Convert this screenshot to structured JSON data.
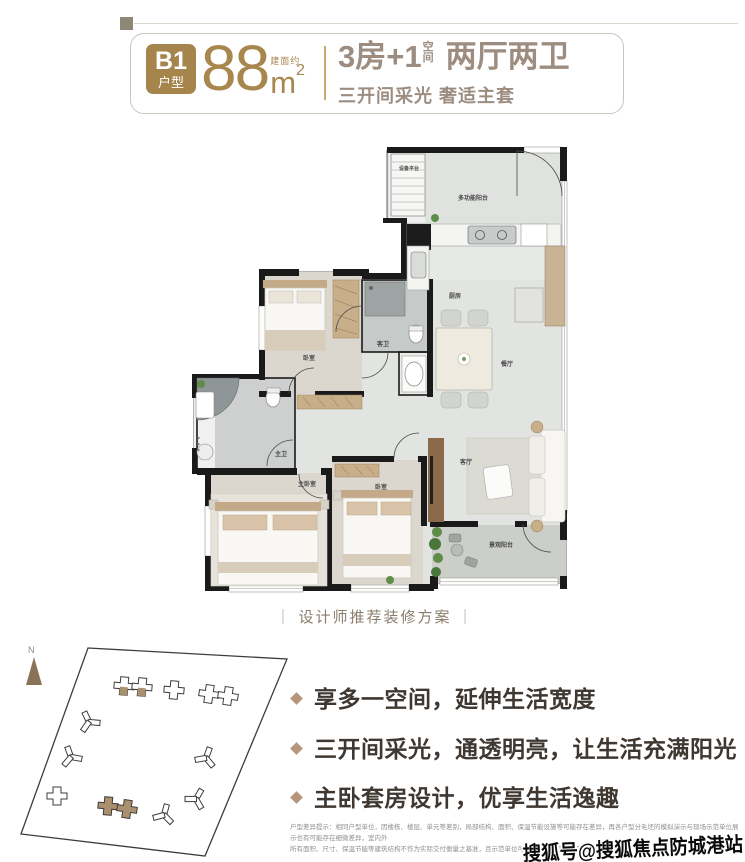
{
  "header": {
    "badge_line1": "B1",
    "badge_line2": "户型",
    "area_prefix": "建面约",
    "area_value": "88",
    "area_unit": "m",
    "area_sup": "2",
    "title_part1": "3房+1",
    "title_stack_top": "空",
    "title_stack_bottom": "间",
    "title_part2": "两厅两卫",
    "subtitle": "三开间采光 奢适主套"
  },
  "floorplan": {
    "rooms": [
      "设备平台",
      "多功能阳台",
      "厨房",
      "客卫",
      "餐厅",
      "卧室",
      "主卫",
      "主卧室",
      "卧室",
      "客厅",
      "景观阳台"
    ]
  },
  "caption": {
    "bar_left": "｜",
    "text": "设计师推荐装修方案",
    "bar_right": "｜"
  },
  "siteplan": {
    "compass_label": "N"
  },
  "features": [
    "享多一空间，延伸生活宽度",
    "三开间采光，通透明亮，让生活充满阳光",
    "主卧套房设计，优享生活逸趣"
  ],
  "disclaimer": {
    "line1": "户型差异提示：相同户型单位，因楼栋、楼层、单元等差别，局部结构、面积、保温节能设施等可能存在差异，再各户型分毛坯的模拟演示与现场示范单位展示也有可能存在细微差异，室内外",
    "line2": "所有面积、尺寸、保温节能等建筑结构不作为实际交付衡量之基准，且示范单位可能存在未包含保温节能等要求。"
  },
  "watermark": "搜狐号@搜狐焦点防城港站",
  "colors": {
    "gold": "#A6854D",
    "taupe": "#9C8D80",
    "text": "#3F3832",
    "bullet": "#B5967C"
  }
}
